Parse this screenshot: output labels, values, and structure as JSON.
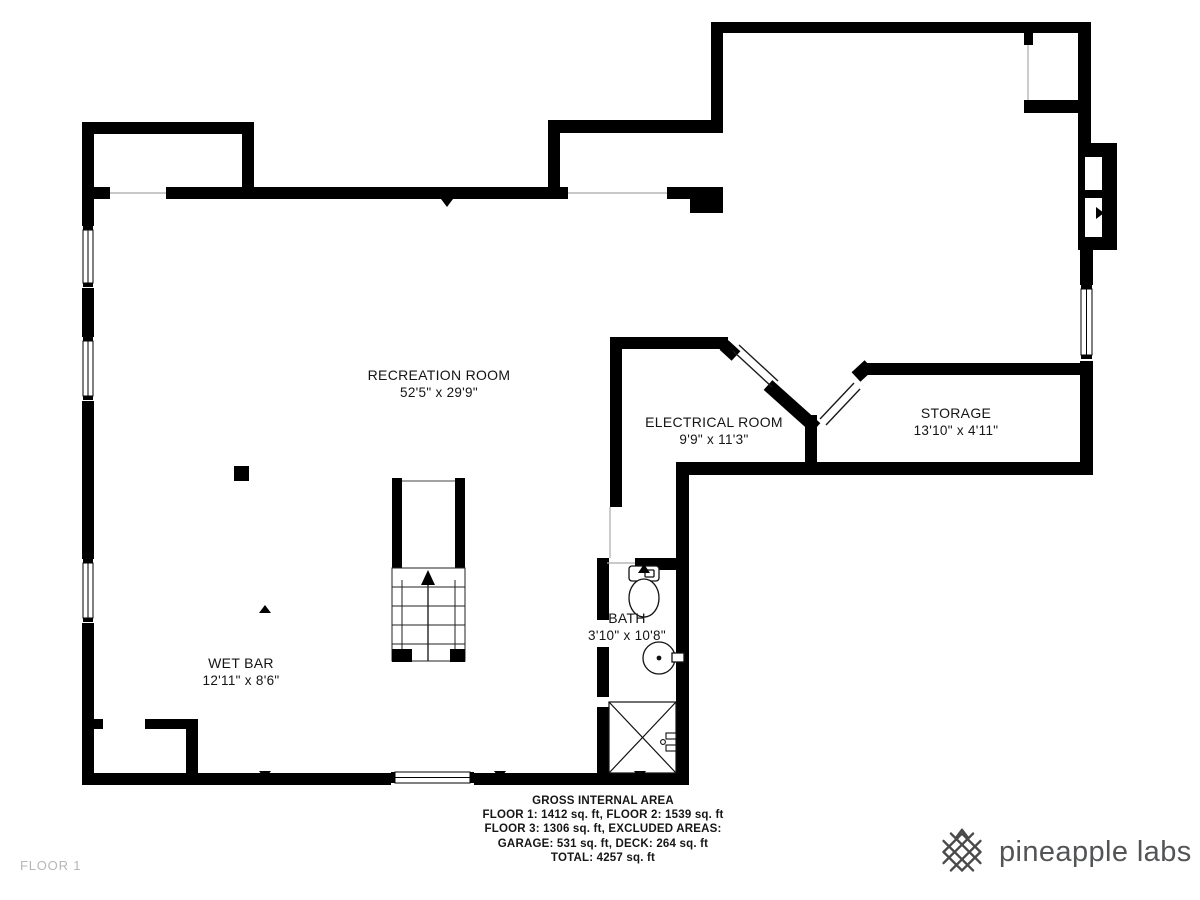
{
  "plan": {
    "floor_label": "FLOOR 1",
    "wall_color": "#000000",
    "rooms": [
      {
        "id": "recreation-room",
        "name": "RECREATION ROOM",
        "dims": "52'5\" x 29'9\""
      },
      {
        "id": "electrical-room",
        "name": "ELECTRICAL ROOM",
        "dims": "9'9\" x 11'3\""
      },
      {
        "id": "storage",
        "name": "STORAGE",
        "dims": "13'10\" x 4'11\""
      },
      {
        "id": "bath",
        "name": "BATH",
        "dims": "3'10\" x 10'8\""
      },
      {
        "id": "wet-bar",
        "name": "WET BAR",
        "dims": "12'11\" x 8'6\""
      }
    ],
    "fixtures": [
      "stairs-icon",
      "toilet-icon",
      "sink-icon",
      "shower-icon",
      "support-column",
      "window-icon",
      "door-opening-icon"
    ]
  },
  "footer": {
    "lines": [
      "GROSS INTERNAL AREA",
      "FLOOR 1: 1412 sq. ft, FLOOR 2: 1539 sq. ft",
      "FLOOR 3: 1306 sq. ft, EXCLUDED AREAS:",
      "GARAGE: 531 sq. ft, DECK: 264 sq. ft",
      "TOTAL: 4257 sq. ft"
    ]
  },
  "brand": {
    "name": "pineapple labs",
    "icon": "pineapple-lattice-icon",
    "color": "#4a4a4b"
  }
}
